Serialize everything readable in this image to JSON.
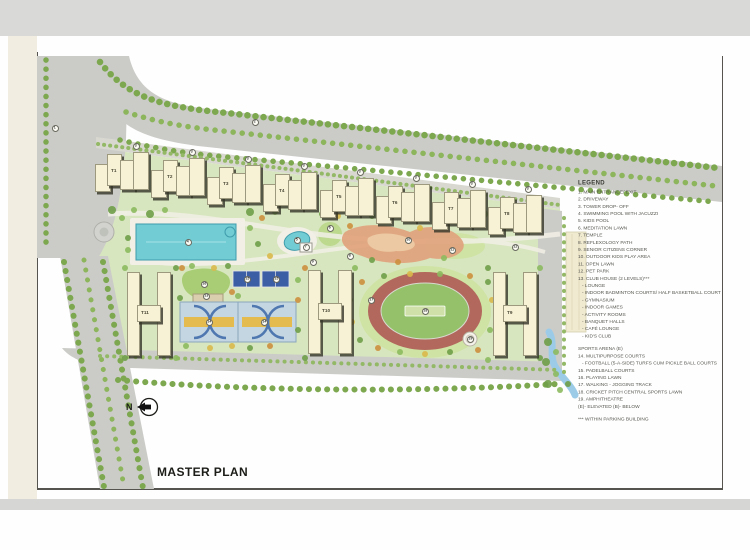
{
  "page": {
    "title_label": "MASTER PLAN",
    "north_label": "N"
  },
  "plan": {
    "towers": [
      {
        "label": "T1"
      },
      {
        "label": "T2"
      },
      {
        "label": "T3"
      },
      {
        "label": "T4"
      },
      {
        "label": "T5"
      },
      {
        "label": "T6"
      },
      {
        "label": "T7"
      },
      {
        "label": "T8"
      },
      {
        "label": "T11"
      },
      {
        "label": "T10"
      },
      {
        "label": "T9"
      }
    ],
    "markers": [
      {
        "n": "1",
        "x": 55,
        "y": 128
      },
      {
        "n": "2",
        "x": 255,
        "y": 122
      },
      {
        "n": "3",
        "x": 136,
        "y": 146
      },
      {
        "n": "3",
        "x": 192,
        "y": 152
      },
      {
        "n": "3",
        "x": 248,
        "y": 159
      },
      {
        "n": "3",
        "x": 304,
        "y": 166
      },
      {
        "n": "3",
        "x": 360,
        "y": 172
      },
      {
        "n": "3",
        "x": 416,
        "y": 178
      },
      {
        "n": "3",
        "x": 472,
        "y": 184
      },
      {
        "n": "3",
        "x": 528,
        "y": 189
      },
      {
        "n": "4",
        "x": 188,
        "y": 242
      },
      {
        "n": "5",
        "x": 297,
        "y": 240
      },
      {
        "n": "6",
        "x": 330,
        "y": 228
      },
      {
        "n": "7",
        "x": 306,
        "y": 247
      },
      {
        "n": "8",
        "x": 350,
        "y": 256
      },
      {
        "n": "9",
        "x": 313,
        "y": 262
      },
      {
        "n": "10",
        "x": 408,
        "y": 240
      },
      {
        "n": "11",
        "x": 452,
        "y": 250
      },
      {
        "n": "12",
        "x": 515,
        "y": 247
      },
      {
        "n": "13",
        "x": 206,
        "y": 296
      },
      {
        "n": "14",
        "x": 209,
        "y": 322
      },
      {
        "n": "14",
        "x": 264,
        "y": 322
      },
      {
        "n": "15",
        "x": 247,
        "y": 279
      },
      {
        "n": "15",
        "x": 276,
        "y": 279
      },
      {
        "n": "16",
        "x": 204,
        "y": 284
      },
      {
        "n": "17",
        "x": 371,
        "y": 300
      },
      {
        "n": "18",
        "x": 425,
        "y": 311
      },
      {
        "n": "19",
        "x": 470,
        "y": 339
      }
    ]
  },
  "legend": {
    "title": "LEGEND",
    "items": [
      {
        "text": "1. MAIN ENTRANCE/ EXIT"
      },
      {
        "text": "2. DRIVEWAY"
      },
      {
        "text": "3. TOWER DROP- OFF"
      },
      {
        "text": "4. SWIMMING POOL WITH JACUZZI"
      },
      {
        "text": "5. KIDS POOL"
      },
      {
        "text": "6. MEDITATION LAWN"
      },
      {
        "text": "7. TEMPLE"
      },
      {
        "text": "8. REFLEXOLOGY PATH"
      },
      {
        "text": "9. SENIOR CITIZENS CORNER"
      },
      {
        "text": "10. OUTDOOR KIDS PLAY AREA"
      },
      {
        "text": "11.  OPEN LAWN"
      },
      {
        "text": "12. PET PARK"
      },
      {
        "text": "13. CLUB HOUSE (2 LEVELS)***"
      },
      {
        "text": "- LOUNGE",
        "cls": "sub"
      },
      {
        "text": "- INDOOR BADMINTON COURTS/ HALF BASKETBALL COURT",
        "cls": "sub"
      },
      {
        "text": "- GYMNASIUM",
        "cls": "sub"
      },
      {
        "text": "- INDOOR GAMES",
        "cls": "sub"
      },
      {
        "text": "- ACTIVITY ROOMS",
        "cls": "sub"
      },
      {
        "text": "- BANQUET HALLS",
        "cls": "sub"
      },
      {
        "text": "- CAFÉ LOUNGE",
        "cls": "sub"
      },
      {
        "text": "- KID'S CLUB",
        "cls": "sub"
      },
      {
        "text": "SPORTS ARENA (E)",
        "cls": "gap"
      },
      {
        "text": "14. MULTIPURPOSE COURTS"
      },
      {
        "text": "- FOOTBALL (5-A-SIDE) TURFS CUM PICKLE BALL COURTS",
        "cls": "sub"
      },
      {
        "text": "15. PADELBALL COURTS"
      },
      {
        "text": "16. PLAYING LAWN"
      },
      {
        "text": "17. WALKING - JOGGING TRACK"
      },
      {
        "text": "18. CRICKET PITCH CENTRAL SPORTS LAWN"
      },
      {
        "text": "19. AMPHITHEATRE"
      },
      {
        "text": "(E)- ELEVATED  (B)- BELOW"
      },
      {
        "text": "*** WITHIN PARKING BUILDING",
        "cls": "gap"
      }
    ]
  },
  "colors": {
    "road": "#cbccc8",
    "site_green": "#d8e6bf",
    "building": "#f7f1d6",
    "pool": "#72ccd4",
    "track_ring": "#b2685c",
    "track_infield": "#94c169",
    "padel_court": "#3c5ea4",
    "multipurpose_court": "#c4d6e2",
    "court_stripe": "#e4bb4e",
    "play_area": "#e0a47e",
    "stream": "#9ccbe8",
    "tree_dark": "#6f9e48",
    "tree_light": "#8cba5e"
  }
}
